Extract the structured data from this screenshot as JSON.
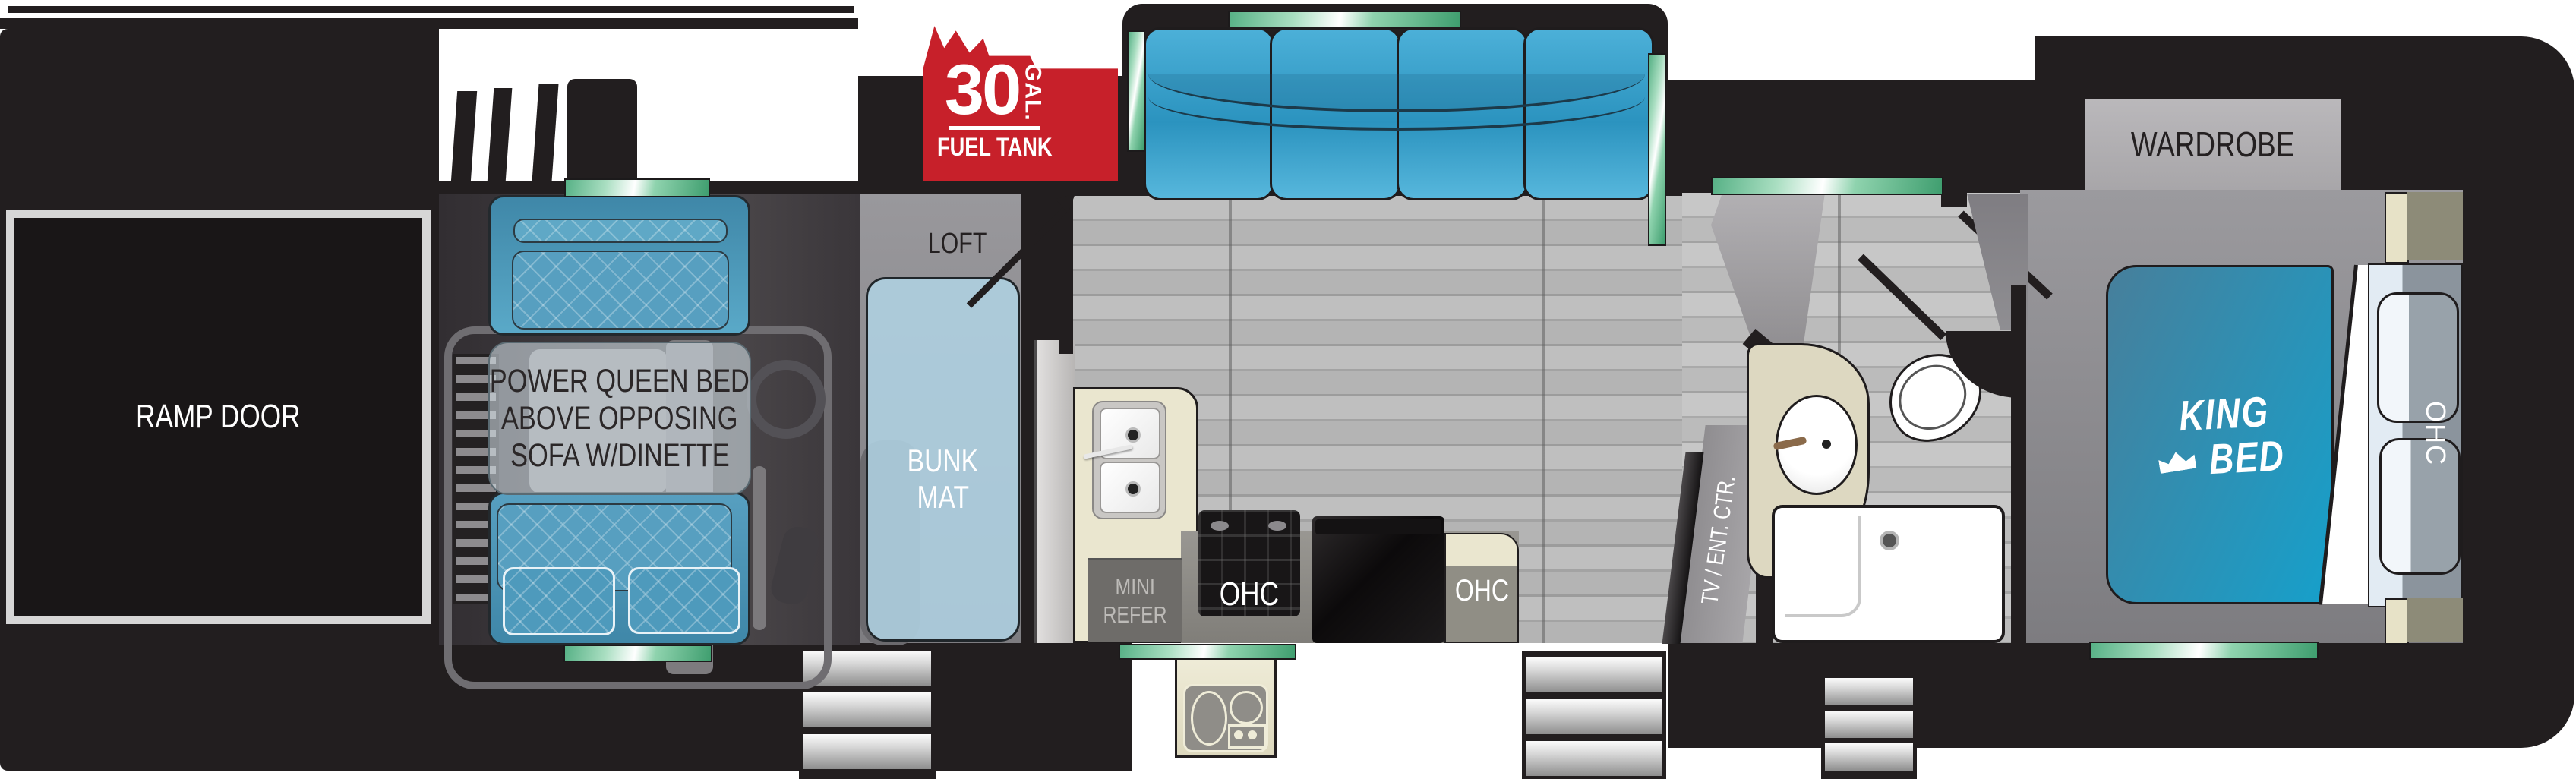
{
  "title": "Toy hauler fifth-wheel RV floor plan",
  "colors": {
    "body_black": "#221e1f",
    "accent_green": "#57b186",
    "fuel_red": "#c7202a",
    "sofa_blue": "#2b93bf",
    "bed_teal": "#16a0cb",
    "counter_cream": "#eae6cf"
  },
  "labels": {
    "ramp_door": "RAMP DOOR",
    "garage_note": {
      "l1": "POWER QUEEN BED",
      "l2": "ABOVE OPPOSING",
      "l3": "SOFA W/DINETTE"
    },
    "loft": "LOFT",
    "bunk": {
      "l1": "BUNK",
      "l2": "MAT"
    },
    "fuel": {
      "value": "30",
      "unit": "GAL.",
      "name": "FUEL TANK"
    },
    "refer": {
      "l1": "MINI",
      "l2": "REFER"
    },
    "ohc_range": "OHC",
    "ohc_cabinet": "OHC",
    "ohc_bedroom": "OHC",
    "tv": "TV / ENT. CTR.",
    "wardrobe": "WARDROBE",
    "king": {
      "l1": "KING",
      "l2": "BED"
    }
  }
}
